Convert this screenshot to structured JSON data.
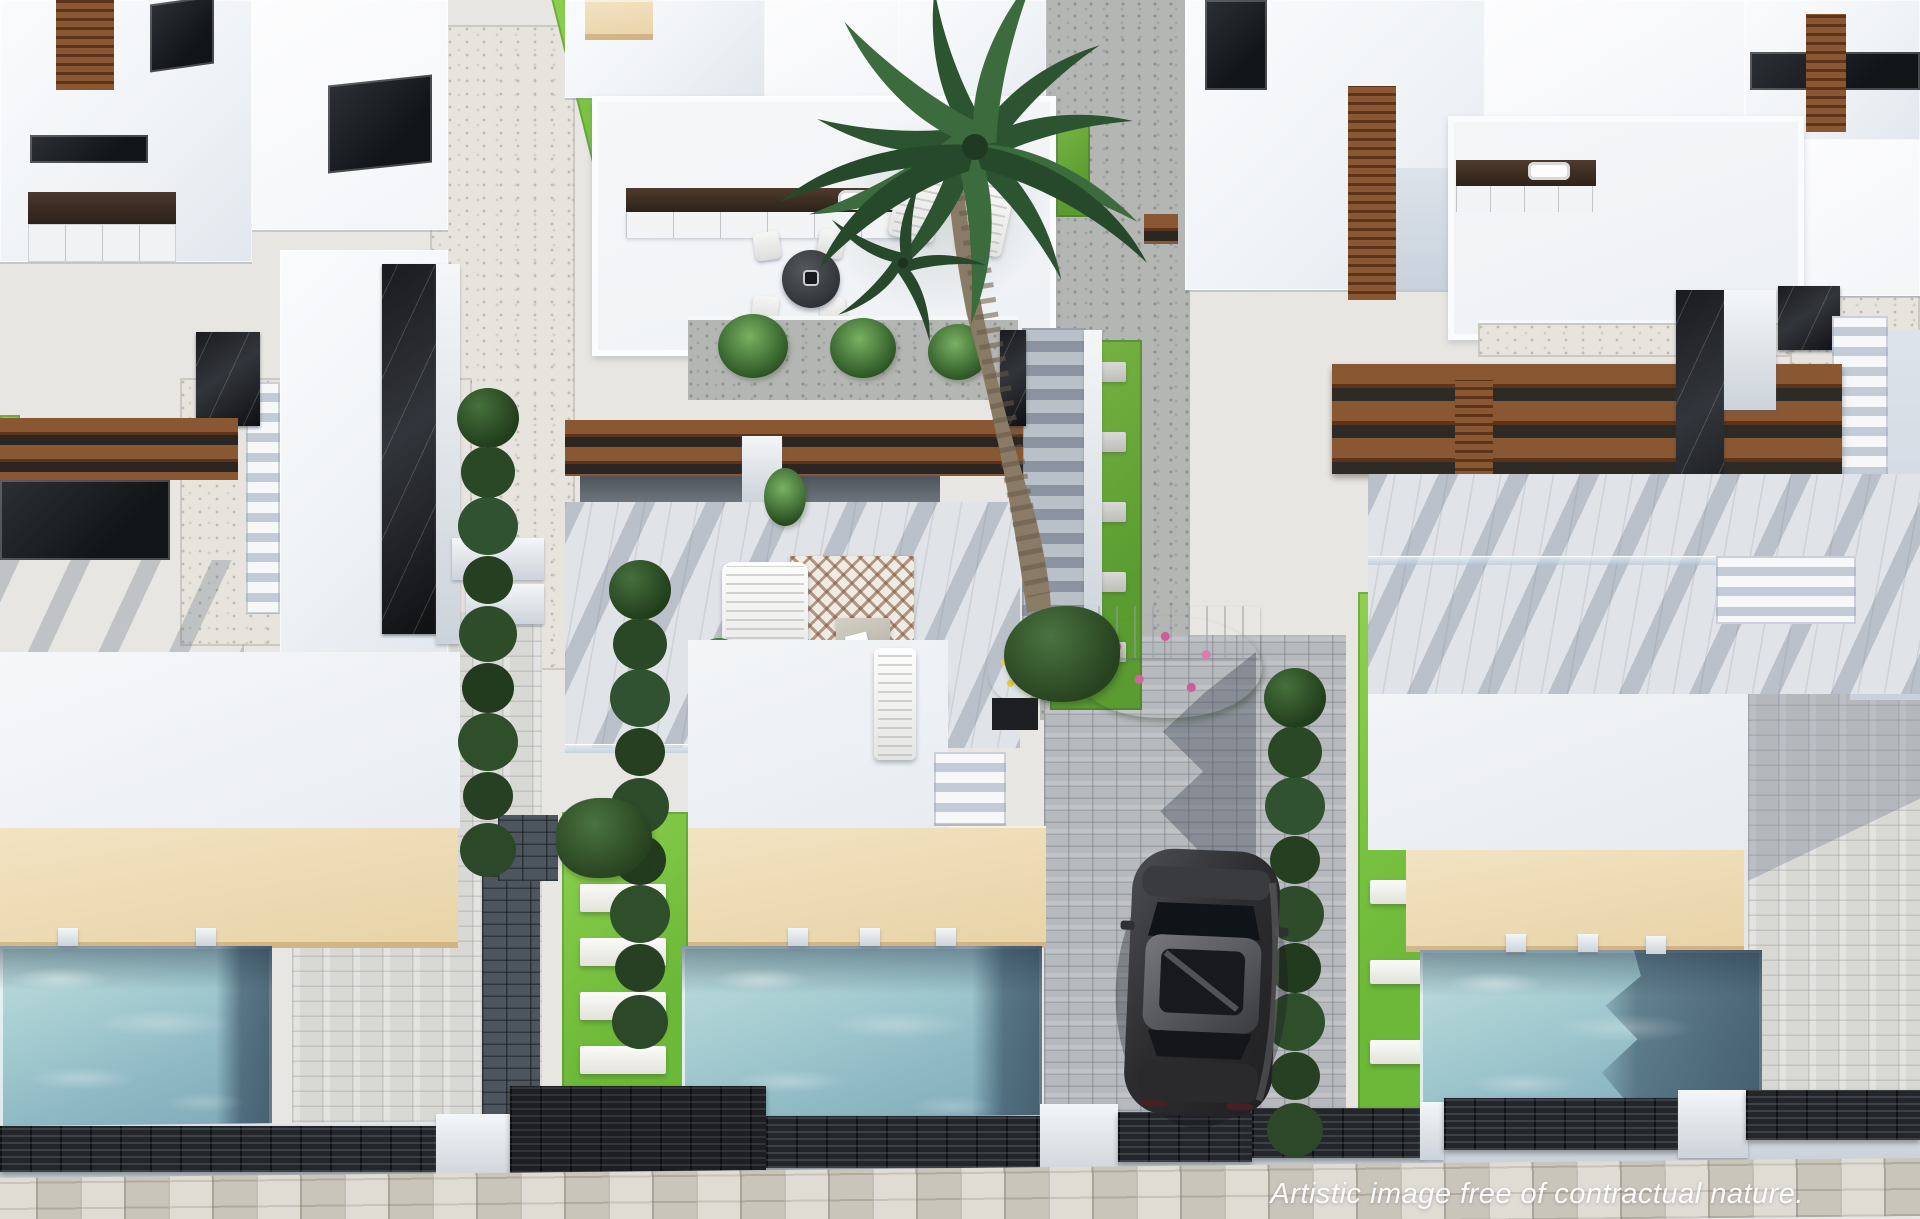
{
  "scene": {
    "type": "aerial 3D architectural render",
    "description": "Bird's-eye view of a row of modern white villas, each with a roof solarium, wood pergola, lawn with stepping stones, beige sun deck, private turquoise pool, gravel side alleys, a tall palm tree, a dark car parked on a herringbone driveway, dark louvred street fences and a stone sidewalk.",
    "watermark": "Artistic image free of contractual nature.",
    "palette": {
      "ground": "#e8e6e2",
      "building_white": "#f4f5f7",
      "shadow_blue": "#c9d2de",
      "pool_light": "#a5ccd1",
      "pool_deep": "#4e6f82",
      "deck_beige": "#e9d3a7",
      "deck_light": "#f2e3c2",
      "grass_green": "#6cb838",
      "grass_light": "#8ed14f",
      "gravel_light": "#e7e4de",
      "paver_grey": "#d8d8d5",
      "paver_dark": "#4d555f",
      "fence_dark": "#23262a",
      "wood_light": "#8a5733",
      "wood_dark": "#5d341a",
      "hedge_green": "#27421f",
      "hedge_light": "#4a7340",
      "palm_green": "#2f5a35",
      "car_dark": "#2b2b2e"
    },
    "properties": [
      {
        "name": "left-villa",
        "features": [
          "roof terrace",
          "open-plan kitchen view",
          "wood pergola",
          "black marble accents",
          "staircase",
          "lawn strip with stepping stones",
          "beige sun deck",
          "private pool",
          "paved patio",
          "white gravel courtyard"
        ]
      },
      {
        "name": "center-villa",
        "features": [
          "roof solarium with outdoor kitchen",
          "round dining set",
          "sun loungers",
          "planter with potted palms",
          "wide staircase",
          "wood pergola",
          "lounge terrace with corner sofa and rug",
          "lawn strip with stepping stones",
          "beige sun deck",
          "private pool",
          "driveway with parked car"
        ]
      },
      {
        "name": "right-villa",
        "features": [
          "roof solarium with outdoor kitchen",
          "large wood pergola",
          "black marble columns",
          "staircases",
          "lawn strip with stepping stones",
          "beige sun deck",
          "private pool",
          "paved patio"
        ]
      }
    ],
    "environment": {
      "vegetation": [
        "tall palm tree",
        "secondary palm crown",
        "cypress hedge along driveway",
        "round shrubs in gravel alley",
        "potted palm shrubs",
        "bougainvillea with pink bloom over gate",
        "planter with yellow flowers"
      ],
      "vehicle": "dark grey car parked nose-in on herringbone driveway",
      "street": "stone tile sidewalk with dark louvred boundary fences and white piers",
      "pool_count": 3
    }
  }
}
